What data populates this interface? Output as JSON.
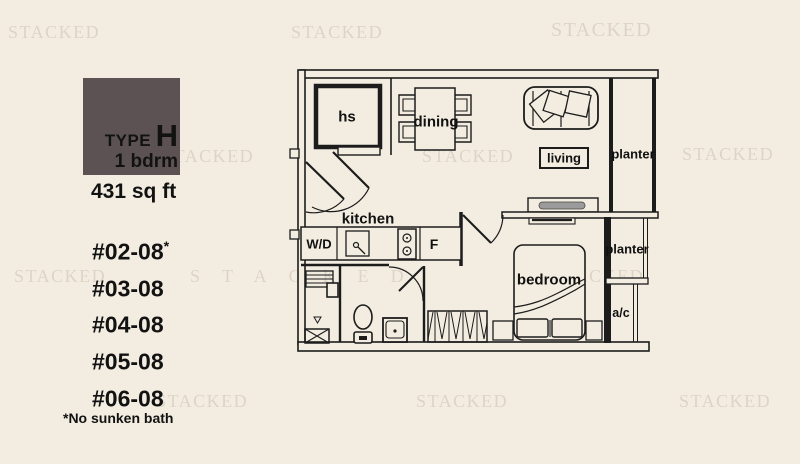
{
  "watermark": {
    "text": "STACKED"
  },
  "panel": {
    "type_label": "TYPE",
    "type_value": "H",
    "bedrooms": "1 bdrm",
    "area": "431 sq ft",
    "units": [
      {
        "label": "#02-08",
        "mark": "*"
      },
      {
        "label": "#03-08",
        "mark": ""
      },
      {
        "label": "#04-08",
        "mark": ""
      },
      {
        "label": "#05-08",
        "mark": ""
      },
      {
        "label": "#06-08",
        "mark": ""
      }
    ],
    "footnote": "*No sunken bath"
  },
  "floorplan": {
    "rooms": {
      "hs": "hs",
      "dining": "dining",
      "living": "living",
      "planter_top": "planter",
      "planter_mid": "planter",
      "kitchen": "kitchen",
      "washer_dryer": "W/D",
      "fridge": "F",
      "bedroom": "bedroom",
      "ac": "a/c"
    }
  },
  "colors": {
    "background": "#f3ede1",
    "walls": "#1c1c1c",
    "watermark": "#ddd4c6",
    "swatch": "#5c5254"
  }
}
